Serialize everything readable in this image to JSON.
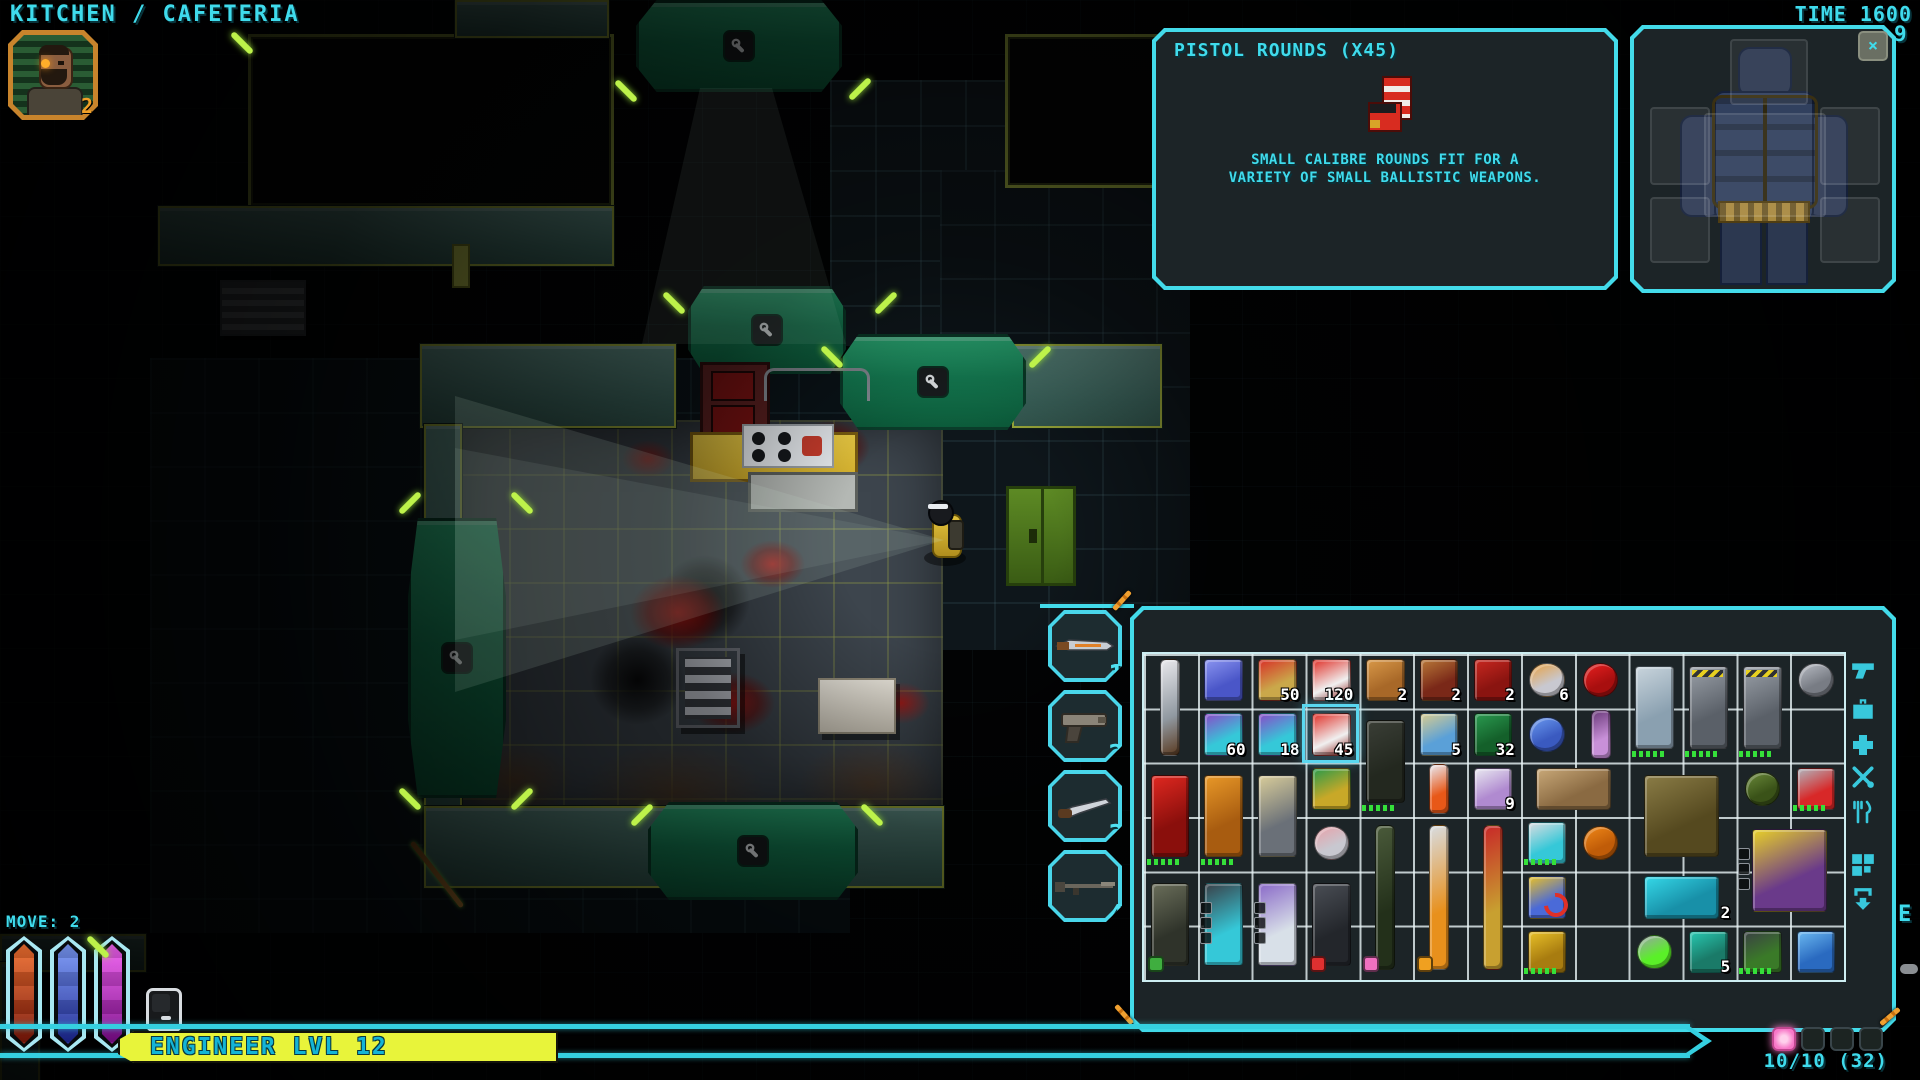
{
  "colors": {
    "accent": "#3fdbec",
    "banner_yellow": "#e8f43a",
    "selection": "#5ad8f0",
    "active_dot": "#f878c8"
  },
  "header": {
    "location_title": "KITCHEN / CAFETERIA",
    "time_label": "TIME 1600",
    "corner_number": "9"
  },
  "portrait": {
    "badge": "2"
  },
  "tooltip": {
    "title": "PISTOL ROUNDS (X45)",
    "item_icon": "pistol-rounds-box",
    "description_line1": "SMALL CALIBRE ROUNDS FIT FOR A",
    "description_line2": "VARIETY OF SMALL BALLISTIC WEAPONS."
  },
  "equipment_panel": {
    "close_label": "×",
    "equipped": [
      "tactical-vest",
      "utility-belt"
    ],
    "slots": [
      "head",
      "chest",
      "left-shoulder",
      "right-shoulder",
      "left-hand",
      "right-hand"
    ]
  },
  "hotbar": [
    {
      "num": "1",
      "weapon": "bayonet-knife"
    },
    {
      "num": "2",
      "weapon": "pistol"
    },
    {
      "num": "3",
      "weapon": "survival-knife"
    },
    {
      "num": "4",
      "weapon": "rifle"
    }
  ],
  "status": {
    "move_label": "MOVE: 2",
    "class_banner": "ENGINEER LVL 12",
    "bars": [
      {
        "name": "health-bar",
        "colors": [
          "#f07030",
          "#7a1508"
        ]
      },
      {
        "name": "endurance-bar",
        "colors": [
          "#7a9af8",
          "#1a2490"
        ]
      },
      {
        "name": "psi-bar",
        "colors": [
          "#f060f0",
          "#7a0a88"
        ]
      }
    ]
  },
  "inventory": {
    "columns": 13,
    "rows": 6,
    "capacity_label": "10/10 (32)",
    "edge_letter": "E",
    "page_dots": [
      {
        "active": true
      },
      {
        "active": false
      },
      {
        "active": false
      },
      {
        "active": false
      }
    ],
    "side_tabs": [
      "pistol",
      "briefcase",
      "medical-cross",
      "repair-tools",
      "food",
      "storage-blocks",
      "transfer-arrow"
    ],
    "items": [
      {
        "name": "combat-knife",
        "c": 1,
        "r": 1,
        "h": 2,
        "colors": [
          "#e8e8ec",
          "#9098a0",
          "#5a3a20"
        ],
        "shape": "blade"
      },
      {
        "name": "crystal-shard",
        "c": 2,
        "r": 1,
        "colors": [
          "#8a94f0",
          "#4a56c8"
        ]
      },
      {
        "name": "rifle-rounds-tin",
        "c": 3,
        "r": 1,
        "count": "50",
        "colors": [
          "#d83028",
          "#caa84a"
        ]
      },
      {
        "name": "pistol-rounds-box",
        "c": 4,
        "r": 1,
        "count": "120",
        "colors": [
          "#e03028",
          "#f0f0f0",
          "#8a1410"
        ]
      },
      {
        "name": "bread",
        "c": 5,
        "r": 1,
        "count": "2",
        "colors": [
          "#d89848",
          "#a86828"
        ]
      },
      {
        "name": "sandwich",
        "c": 6,
        "r": 1,
        "count": "2",
        "colors": [
          "#b87838",
          "#7a2818"
        ]
      },
      {
        "name": "ration-pack",
        "c": 7,
        "r": 1,
        "count": "2",
        "colors": [
          "#c82820",
          "#8a1410"
        ]
      },
      {
        "name": "pie",
        "c": 8,
        "r": 1,
        "count": "6",
        "colors": [
          "#e8a040",
          "#c8c8d0"
        ],
        "shape": "round"
      },
      {
        "name": "red-capsules",
        "c": 9,
        "r": 1,
        "colors": [
          "#e82020",
          "#a80f0f"
        ],
        "shape": "round"
      },
      {
        "name": "metal-canister",
        "c": 10,
        "r": 1,
        "h": 2,
        "colors": [
          "#c8d4dc",
          "#8aa0b0"
        ],
        "pips": true
      },
      {
        "name": "armored-locker",
        "c": 11,
        "r": 1,
        "h": 2,
        "colors": [
          "#9aa0a8",
          "#5a6068"
        ],
        "pips": true,
        "accent": "#e8d020"
      },
      {
        "name": "armored-locker",
        "c": 12,
        "r": 1,
        "h": 2,
        "colors": [
          "#9aa0a8",
          "#5a6068"
        ],
        "pips": true,
        "accent": "#e8d020"
      },
      {
        "name": "duct-tape",
        "c": 13,
        "r": 1,
        "colors": [
          "#b8bcc4",
          "#787c84"
        ],
        "shape": "round"
      },
      {
        "name": "stim-syringes",
        "c": 2,
        "r": 2,
        "count": "60",
        "colors": [
          "#8a4ac8",
          "#35c8d8"
        ]
      },
      {
        "name": "stim-syringes",
        "c": 3,
        "r": 2,
        "count": "18",
        "colors": [
          "#8a4ac8",
          "#35c8d8"
        ]
      },
      {
        "name": "pistol-rounds",
        "c": 4,
        "r": 2,
        "count": "45",
        "colors": [
          "#e03028",
          "#f0f0f0",
          "#8a1410"
        ],
        "selected": true
      },
      {
        "name": "deployable-turret",
        "c": 5,
        "r": 2,
        "h": 2,
        "colors": [
          "#3a3e36",
          "#23281f"
        ],
        "pips": true
      },
      {
        "name": "rifle-ammo-box",
        "c": 6,
        "r": 2,
        "count": "5",
        "colors": [
          "#d8cc90",
          "#5aa0d8"
        ]
      },
      {
        "name": "ammo-crate",
        "c": 7,
        "r": 2,
        "count": "32",
        "colors": [
          "#2a9a50",
          "#14602a"
        ]
      },
      {
        "name": "soap-bar",
        "c": 8,
        "r": 2,
        "colors": [
          "#6a9af0",
          "#3a5ac0"
        ],
        "shape": "round"
      },
      {
        "name": "alien-feather",
        "c": 9,
        "r": 2,
        "colors": [
          "#6a3a7a",
          "#c890d8"
        ],
        "shape": "blade"
      },
      {
        "name": "red-cabinet",
        "c": 1,
        "r": 3,
        "h": 2,
        "colors": [
          "#e02820",
          "#8a0f0c"
        ],
        "pips": true
      },
      {
        "name": "orange-cabinet",
        "c": 2,
        "r": 3,
        "h": 2,
        "colors": [
          "#e89828",
          "#a85c10"
        ],
        "pips": true
      },
      {
        "name": "grapple-tool",
        "c": 3,
        "r": 3,
        "h": 2,
        "colors": [
          "#d8cc9a",
          "#6a7078"
        ]
      },
      {
        "name": "circuit-plate",
        "c": 4,
        "r": 3,
        "colors": [
          "#2a9a4a",
          "#c8a828"
        ]
      },
      {
        "name": "chem-vial",
        "c": 6,
        "r": 3,
        "colors": [
          "#e8e8f0",
          "#e85818"
        ],
        "shape": "blade"
      },
      {
        "name": "storage-cube",
        "c": 7,
        "r": 3,
        "count": "9",
        "colors": [
          "#e8e8f0",
          "#b08ad0"
        ]
      },
      {
        "name": "tactical-harness",
        "c": 8,
        "r": 3,
        "w": 2,
        "colors": [
          "#c8a878",
          "#8a6a42"
        ]
      },
      {
        "name": "combat-vest",
        "c": 10,
        "r": 3,
        "w": 2,
        "h": 2,
        "colors": [
          "#8a7c46",
          "#55491f"
        ]
      },
      {
        "name": "slime-helmet",
        "c": 12,
        "r": 3,
        "colors": [
          "#6a8a3a",
          "#3a5218"
        ],
        "shape": "round"
      },
      {
        "name": "robot-module",
        "c": 13,
        "r": 3,
        "colors": [
          "#b0b4bc",
          "#d82828"
        ],
        "pips": true
      },
      {
        "name": "meat-plate",
        "c": 4,
        "r": 4,
        "colors": [
          "#e8a0a8",
          "#c8c8d0"
        ],
        "shape": "round"
      },
      {
        "name": "assault-rifle",
        "c": 5,
        "r": 4,
        "h": 3,
        "colors": [
          "#4a5a3a",
          "#23301a"
        ],
        "dot": "#f070c0",
        "shape": "blade"
      },
      {
        "name": "machete",
        "c": 6,
        "r": 4,
        "h": 3,
        "colors": [
          "#d8dce0",
          "#e8901c"
        ],
        "dot": "#f0a020",
        "shape": "blade"
      },
      {
        "name": "red-spear",
        "c": 7,
        "r": 4,
        "h": 3,
        "colors": [
          "#c82828",
          "#c8a030"
        ],
        "shape": "blade"
      },
      {
        "name": "pager",
        "c": 8,
        "r": 4,
        "colors": [
          "#d8dce0",
          "#35c8d8"
        ],
        "pips": true
      },
      {
        "name": "orange-pills",
        "c": 9,
        "r": 4,
        "colors": [
          "#f08818",
          "#c05c08"
        ],
        "shape": "round"
      },
      {
        "name": "ornate-armor",
        "c": 12,
        "r": 4,
        "w": 2,
        "h": 2,
        "colors": [
          "#e8d028",
          "#6a3a8a"
        ],
        "mods": true
      },
      {
        "name": "sidearm-pistol",
        "c": 1,
        "r": 5,
        "h": 2,
        "colors": [
          "#6a6e5a",
          "#2f332a"
        ],
        "dot": "#3fae3f"
      },
      {
        "name": "cyan-pistol",
        "c": 2,
        "r": 5,
        "h": 2,
        "colors": [
          "#3a4048",
          "#35c8d8"
        ],
        "mods": true
      },
      {
        "name": "energy-pistol",
        "c": 3,
        "r": 5,
        "h": 2,
        "colors": [
          "#8a6ac8",
          "#d8e0e8"
        ],
        "mods": true
      },
      {
        "name": "revolver",
        "c": 4,
        "r": 5,
        "h": 2,
        "colors": [
          "#4a4e55",
          "#23262b"
        ],
        "dot": "#e03030"
      },
      {
        "name": "key-carabiner",
        "c": 8,
        "r": 5,
        "colors": [
          "#e8c028",
          "#4a6ad8"
        ],
        "overlay": "red-arrow"
      },
      {
        "name": "thermal-blanket",
        "c": 10,
        "r": 5,
        "w": 2,
        "count": "2",
        "colors": [
          "#35d8e8",
          "#1890a8"
        ]
      },
      {
        "name": "wrench",
        "c": 8,
        "r": 6,
        "colors": [
          "#e8c028",
          "#a87c10"
        ],
        "pips": true
      },
      {
        "name": "hover-discs",
        "c": 10,
        "r": 6,
        "colors": [
          "#9aa0a8",
          "#5af028"
        ],
        "shape": "round"
      },
      {
        "name": "powered-gadget",
        "c": 11,
        "r": 6,
        "count": "5",
        "colors": [
          "#28c8b0",
          "#1a7a68"
        ]
      },
      {
        "name": "scanner-device",
        "c": 12,
        "r": 6,
        "colors": [
          "#3a4044",
          "#3a7a28"
        ],
        "pips": true
      },
      {
        "name": "glass-cube",
        "c": 13,
        "r": 6,
        "colors": [
          "#6ab8f0",
          "#2a6ac0"
        ]
      }
    ]
  },
  "map": {
    "objects": [
      "kitchen-counter",
      "stove",
      "oven",
      "dining-table",
      "waste-bin",
      "green-locker",
      "player-character",
      "blood-stains",
      "door-modules",
      "wall-vent"
    ],
    "door_icon": "wrench"
  }
}
